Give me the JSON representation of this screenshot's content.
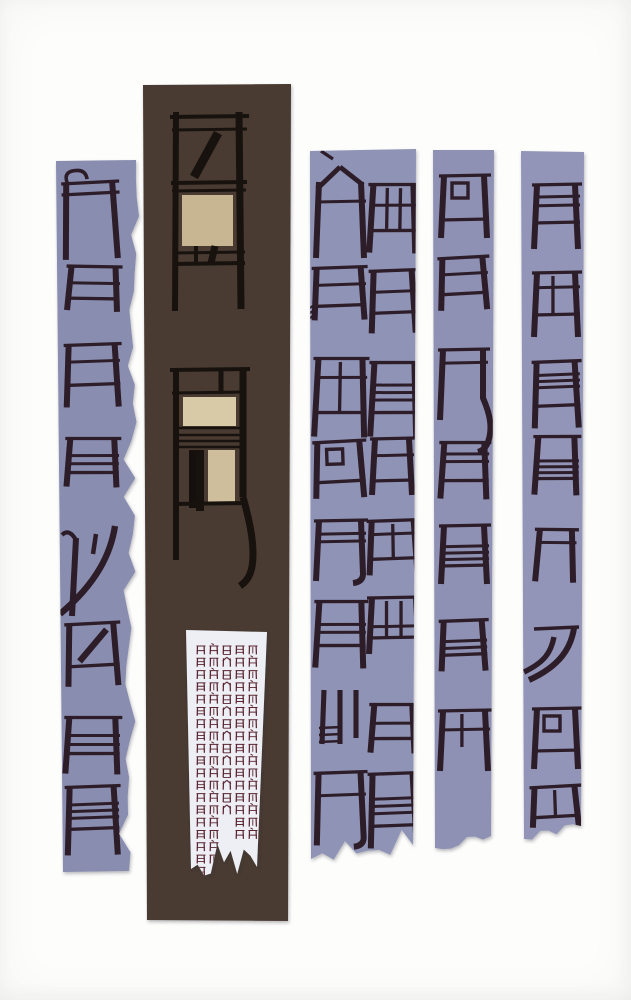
{
  "artwork": {
    "description": "screenprint of chair-glyph calligraphy on torn paper strips",
    "colors": {
      "background": "#fdfdfc",
      "strip1": "#898daf",
      "strip3": "#8f93b5",
      "strip4": "#8e91b3",
      "strip5": "#9295b7",
      "brown": "#493a33",
      "glyph": "#2d1d29",
      "chair_black": "#18120e",
      "tan1": "#c8b591",
      "tan2": "#d9caa7",
      "tan3": "#cebe9b",
      "black": "#15100d",
      "paper": "#edeff4",
      "mini": "#5a2531",
      "shadow": "#2a2a33"
    },
    "strips": [
      {
        "name": "paper-strip-1",
        "fill": "strip1",
        "corners": [
          [
            56,
            161
          ],
          [
            136,
            160
          ],
          [
            129,
            871
          ],
          [
            63,
            872
          ]
        ],
        "torn": "right",
        "amp": 5,
        "seg": 38,
        "seed": 11,
        "clip": "s1"
      },
      {
        "name": "paper-strip-brown",
        "fill": "brown",
        "corners": [
          [
            143,
            85
          ],
          [
            291,
            84
          ],
          [
            288,
            921
          ],
          [
            147,
            920
          ]
        ],
        "torn": null,
        "amp": 0,
        "seg": 1,
        "seed": 2,
        "clip": "s2"
      },
      {
        "name": "paper-strip-3",
        "fill": "strip3",
        "corners": [
          [
            310,
            151
          ],
          [
            416,
            149
          ],
          [
            413,
            845
          ],
          [
            311,
            859
          ]
        ],
        "torn": "bottom",
        "amp": 7,
        "seg": 9,
        "seed": 7,
        "clip": "s3"
      },
      {
        "name": "paper-strip-4",
        "fill": "strip4",
        "corners": [
          [
            433,
            150
          ],
          [
            494,
            150
          ],
          [
            491,
            836
          ],
          [
            435,
            848
          ]
        ],
        "torn": "bottom",
        "amp": 5,
        "seg": 7,
        "seed": 5,
        "clip": "s4"
      },
      {
        "name": "paper-strip-5",
        "fill": "strip5",
        "corners": [
          [
            521,
            151
          ],
          [
            584,
            152
          ],
          [
            581,
            826
          ],
          [
            524,
            839
          ]
        ],
        "torn": "bottom",
        "amp": 6,
        "seg": 7,
        "seed": 9,
        "clip": "s5"
      }
    ],
    "glyph_sets": [
      {
        "clip": "s1",
        "items": [
          {
            "cx": 90,
            "cy": 206,
            "w": 46,
            "h": 46,
            "legs": 30,
            "rot": -2,
            "top": 2,
            "curl": 1
          },
          {
            "cx": 93,
            "cy": 283,
            "w": 44,
            "h": 32,
            "legs": 12,
            "rot": 2,
            "top": 1,
            "bars": [
              0.52
            ],
            "base": 1
          },
          {
            "cx": 92,
            "cy": 365,
            "w": 46,
            "h": 40,
            "legs": 22,
            "rot": -1,
            "top": 1,
            "bars": [
              0.42
            ],
            "base": 1
          },
          {
            "cx": 92,
            "cy": 456,
            "w": 44,
            "h": 34,
            "legs": 14,
            "rot": 1,
            "top": 1,
            "bars": [
              0.5,
              0.74
            ],
            "base": 1
          },
          {
            "cx": 90,
            "cy": 560,
            "w": 44,
            "h": 56,
            "legs": 28,
            "rot": 0,
            "custom": "swoosh1"
          },
          {
            "cx": 92,
            "cy": 645,
            "w": 44,
            "h": 42,
            "legs": 20,
            "rot": -2,
            "top": 1,
            "diag": 1,
            "base": 1
          },
          {
            "cx": 92,
            "cy": 736,
            "w": 46,
            "h": 36,
            "legs": 20,
            "rot": 1,
            "top": 1,
            "bars": [
              0.5,
              0.75
            ],
            "base": 1
          },
          {
            "cx": 92,
            "cy": 808,
            "w": 44,
            "h": 42,
            "legs": 26,
            "rot": -1,
            "top": 1,
            "bars": [
              0.42,
              0.58,
              0.74
            ],
            "base": 1
          }
        ]
      },
      {
        "clip": "s3",
        "items": [
          {
            "cx": 340,
            "cy": 202,
            "w": 42,
            "h": 52,
            "legs": 30,
            "rot": 0,
            "apex": 1,
            "accent": 1,
            "bars": [
              0.5
            ]
          },
          {
            "cx": 339,
            "cy": 287,
            "w": 44,
            "h": 38,
            "legs": 14,
            "rot": -1,
            "top": 1,
            "bars": [
              0.45
            ],
            "base": 1,
            "comb": 1
          },
          {
            "cx": 340,
            "cy": 386,
            "w": 44,
            "h": 54,
            "legs": 24,
            "rot": 1,
            "top": 1,
            "bars": [
              0.35
            ],
            "iv": [
              0.5
            ],
            "base": 1
          },
          {
            "cx": 339,
            "cy": 462,
            "w": 42,
            "h": 40,
            "legs": 16,
            "rot": -2,
            "top": 1,
            "sq": 1,
            "base": 1
          },
          {
            "cx": 340,
            "cy": 540,
            "w": 42,
            "h": 38,
            "legs": 22,
            "rot": 0,
            "top": 1,
            "bars": [
              0.35,
              0.55
            ],
            "flick": "in"
          },
          {
            "cx": 340,
            "cy": 624,
            "w": 42,
            "h": 44,
            "legs": 22,
            "rot": 1,
            "top": 1,
            "bars": [
              0.52,
              0.7
            ],
            "base": 1
          },
          {
            "cx": 340,
            "cy": 716,
            "w": 44,
            "h": 52,
            "legs": 0,
            "rot": 0,
            "custom": "trident"
          },
          {
            "cx": 340,
            "cy": 798,
            "w": 42,
            "h": 50,
            "legs": 22,
            "rot": -1,
            "top": 1,
            "bars": [
              0.45
            ],
            "flick": "in"
          },
          {
            "cx": 393,
            "cy": 208,
            "w": 40,
            "h": 46,
            "legs": 22,
            "rot": 1,
            "top": 1,
            "bars": [
              0.45
            ],
            "iv": [
              0.35,
              0.68
            ],
            "base": 1
          },
          {
            "cx": 393,
            "cy": 292,
            "w": 38,
            "h": 42,
            "legs": 20,
            "rot": -1,
            "top": 1,
            "bars": [
              0.5
            ],
            "base": 1
          },
          {
            "cx": 394,
            "cy": 388,
            "w": 40,
            "h": 50,
            "legs": 24,
            "rot": 1,
            "top": 1,
            "bars": [
              0.45,
              0.6,
              0.75
            ],
            "base": 1
          },
          {
            "cx": 392,
            "cy": 460,
            "w": 34,
            "h": 42,
            "legs": 14,
            "rot": 0,
            "top": 1,
            "bars": [
              0.4
            ],
            "base": 1
          },
          {
            "cx": 393,
            "cy": 540,
            "w": 42,
            "h": 38,
            "legs": 16,
            "rot": -1,
            "top": 1,
            "bars": [
              0.35
            ],
            "iv": [
              0.5
            ],
            "base": 1
          },
          {
            "cx": 394,
            "cy": 618,
            "w": 44,
            "h": 40,
            "legs": 16,
            "rot": 0,
            "top": 1,
            "iv": [
              0.33,
              0.66
            ],
            "bars": [
              0.72
            ],
            "base": 1
          },
          {
            "cx": 393,
            "cy": 722,
            "w": 38,
            "h": 34,
            "legs": 14,
            "rot": 1,
            "top": 1,
            "bars": [
              0.55
            ],
            "base": 1
          },
          {
            "cx": 393,
            "cy": 800,
            "w": 40,
            "h": 52,
            "legs": 22,
            "rot": -1,
            "top": 1,
            "bars": [
              0.48,
              0.62,
              0.76
            ],
            "base": 1
          }
        ]
      },
      {
        "clip": "s4",
        "items": [
          {
            "cx": 464,
            "cy": 198,
            "w": 40,
            "h": 44,
            "legs": 18,
            "rot": 0,
            "top": 1,
            "sq": 1,
            "base": 1
          },
          {
            "cx": 463,
            "cy": 276,
            "w": 40,
            "h": 36,
            "legs": 16,
            "rot": -2,
            "top": 1,
            "bars": [
              0.45
            ],
            "base": 1
          },
          {
            "cx": 463,
            "cy": 372,
            "w": 40,
            "h": 44,
            "legs": 26,
            "rot": 0,
            "top": 1,
            "bars": [
              0.3
            ],
            "flick": "outlong"
          },
          {
            "cx": 464,
            "cy": 462,
            "w": 40,
            "h": 38,
            "legs": 18,
            "rot": 1,
            "top": 1,
            "bars": [
              0.3,
              0.5
            ],
            "base": 1
          },
          {
            "cx": 464,
            "cy": 546,
            "w": 40,
            "h": 40,
            "legs": 18,
            "rot": 0,
            "top": 1,
            "bars": [
              0.52,
              0.68,
              0.84
            ],
            "base": 1
          },
          {
            "cx": 463,
            "cy": 638,
            "w": 38,
            "h": 34,
            "legs": 16,
            "rot": -1,
            "top": 1,
            "bars": [
              0.6,
              0.8
            ],
            "base": 1
          },
          {
            "cx": 464,
            "cy": 730,
            "w": 42,
            "h": 38,
            "legs": 22,
            "rot": 0,
            "top": 1,
            "bars": [
              0.5
            ],
            "iv": [
              0.45
            ]
          }
        ]
      },
      {
        "clip": "s5",
        "items": [
          {
            "cx": 556,
            "cy": 204,
            "w": 38,
            "h": 38,
            "legs": 26,
            "rot": 0,
            "top": 1,
            "bars": [
              0.32,
              0.55
            ],
            "base": 1
          },
          {
            "cx": 556,
            "cy": 294,
            "w": 38,
            "h": 42,
            "legs": 22,
            "rot": 0,
            "top": 1,
            "bars": [
              0.35
            ],
            "iv": [
              0.42
            ],
            "base": 1
          },
          {
            "cx": 556,
            "cy": 384,
            "w": 38,
            "h": 44,
            "legs": 22,
            "rot": -1,
            "top": 1,
            "bars": [
              0.3,
              0.44,
              0.58
            ],
            "base": 1
          },
          {
            "cx": 556,
            "cy": 458,
            "w": 36,
            "h": 42,
            "legs": 16,
            "rot": 1,
            "top": 1,
            "bars": [
              0.58,
              0.72,
              0.86
            ],
            "base": 1
          },
          {
            "cx": 555,
            "cy": 556,
            "w": 32,
            "h": 52,
            "legs": 0,
            "rot": 2,
            "top": 1,
            "bars": [
              0.25
            ]
          },
          {
            "cx": 555,
            "cy": 652,
            "w": 38,
            "h": 48,
            "legs": 0,
            "rot": 0,
            "custom": "swoosh2"
          },
          {
            "cx": 556,
            "cy": 730,
            "w": 38,
            "h": 42,
            "legs": 18,
            "rot": 0,
            "top": 1,
            "sq": 1,
            "base": 1
          },
          {
            "cx": 555,
            "cy": 802,
            "w": 40,
            "h": 30,
            "legs": 10,
            "rot": -2,
            "top": 1,
            "iv": [
              0.5
            ],
            "base": 1
          }
        ]
      }
    ],
    "chairs": [
      {
        "name": "chair-figure-1",
        "lines": [
          [
            176,
            112,
            175,
            311,
            6
          ],
          [
            239,
            112,
            241,
            309,
            7
          ],
          [
            170,
            117,
            249,
            116,
            4
          ],
          [
            172,
            130,
            247,
            129,
            3
          ],
          [
            218,
            133,
            194,
            177,
            9
          ],
          [
            171,
            183,
            247,
            182,
            4
          ],
          [
            172,
            191,
            246,
            190,
            3
          ],
          [
            173,
            253,
            245,
            252,
            3
          ],
          [
            173,
            264,
            245,
            263,
            4
          ],
          [
            196,
            246,
            196,
            263,
            4
          ],
          [
            215,
            246,
            211,
            263,
            7
          ]
        ],
        "curves": [],
        "rects": [
          [
            182,
            195,
            51,
            51,
            "tan1"
          ]
        ]
      },
      {
        "name": "chair-figure-2",
        "lines": [
          [
            176,
            368,
            176,
            560,
            6
          ],
          [
            243,
            368,
            243,
            497,
            7
          ],
          [
            170,
            370,
            250,
            369,
            4
          ],
          [
            221,
            370,
            221,
            394,
            5
          ],
          [
            172,
            393,
            246,
            392,
            3
          ],
          [
            178,
            428,
            243,
            428,
            2.6
          ],
          [
            178,
            435,
            243,
            435,
            2.6
          ],
          [
            178,
            441,
            243,
            441,
            2.6
          ],
          [
            178,
            447,
            243,
            447,
            2.6
          ],
          [
            200,
            450,
            200,
            511,
            8
          ],
          [
            174,
            504,
            246,
            503,
            4
          ]
        ],
        "curves": [
          [
            "M243,497 C249,519 253,537 253,554 C253,571 249,580 240,586",
            7
          ]
        ],
        "rects": [
          [
            183,
            397,
            53,
            29,
            "tan2"
          ],
          [
            208,
            450,
            27,
            53,
            "tan3"
          ],
          [
            189,
            450,
            9,
            58,
            "black"
          ]
        ]
      }
    ],
    "paper_slip": {
      "name": "paper-slip",
      "fill": "paper",
      "corners": [
        [
          186,
          630
        ],
        [
          267,
          632
        ],
        [
          257,
          867
        ],
        [
          191,
          869
        ]
      ],
      "torn": "bottom",
      "amp": 12,
      "seg": 10,
      "seed": 3,
      "clip": "sp"
    },
    "mini_grid": {
      "x0": 197.5,
      "y0": 646,
      "dx": 13,
      "dy": 12.3,
      "rows": [
        "11111",
        "11111",
        "11111",
        "11111",
        "11111",
        "11111",
        "11111",
        "11111",
        "11111",
        "11111",
        "11111",
        "11111",
        "11111",
        "11111",
        "11011",
        "11011",
        "11000",
        "11000",
        "10000"
      ]
    }
  }
}
